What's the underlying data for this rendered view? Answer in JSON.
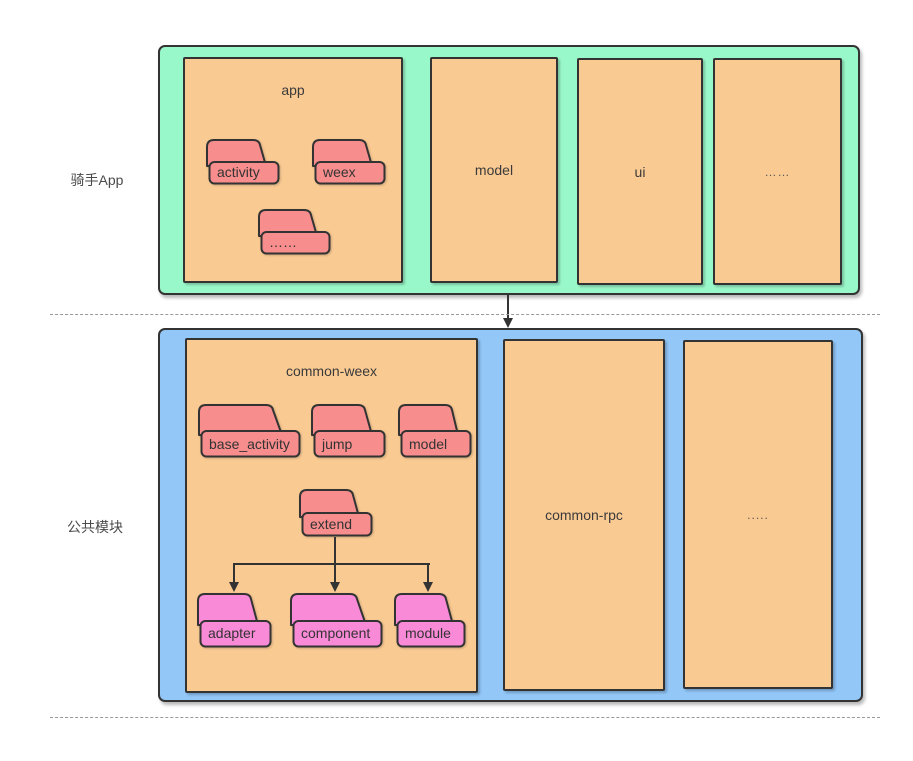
{
  "colors": {
    "top_section_bg": "#99F8C9",
    "bottom_section_bg": "#92C7F8",
    "module_bg": "#FACA93",
    "folder_red": "#F78D8D",
    "folder_pink": "#F98AD7",
    "outline": "#333333",
    "divider": "#999999"
  },
  "left_labels": {
    "top": "骑手App",
    "bottom": "公共模块"
  },
  "top_section": {
    "app": {
      "title": "app",
      "folders": {
        "activity": "activity",
        "weex": "weex",
        "more": "……"
      }
    },
    "model": "model",
    "ui": "ui",
    "more": "……"
  },
  "bottom_section": {
    "common_weex": {
      "title": "common-weex",
      "folders": {
        "base_activity": "base_activity",
        "jump": "jump",
        "model": "model",
        "extend": "extend",
        "adapter": "adapter",
        "component": "component",
        "module": "module"
      }
    },
    "common_rpc": "common-rpc",
    "more": "....."
  }
}
